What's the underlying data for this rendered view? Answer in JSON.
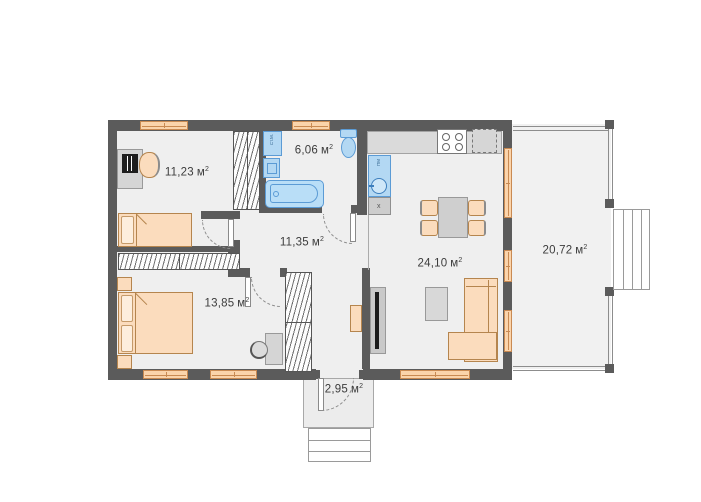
{
  "plan": {
    "unit": {
      "base": "м",
      "sup": "2"
    },
    "rooms": [
      {
        "id": "bedroom-1",
        "area": "11,23"
      },
      {
        "id": "bathroom",
        "area": "6,06"
      },
      {
        "id": "hallway",
        "area": "11,35"
      },
      {
        "id": "bedroom-2",
        "area": "13,85"
      },
      {
        "id": "kitchen-living",
        "area": "24,10"
      },
      {
        "id": "terrace",
        "area": "20,72"
      },
      {
        "id": "porch",
        "area": "2,95"
      }
    ],
    "appliances": {
      "washing_machine": "Ст.М.",
      "dishwasher": "ПМ",
      "vent_unit": "х"
    },
    "colors": {
      "wall": "#5b5b5b",
      "floor": "#efefef",
      "window_wood": "#fbd4ab",
      "furniture_wood": "#fbdcbd",
      "plumbing_fill": "#b3d8f3",
      "plumbing_stroke": "#5b9bd5",
      "gray_furniture": "#d5d5d5",
      "label_text": "#3c3c3c"
    }
  }
}
